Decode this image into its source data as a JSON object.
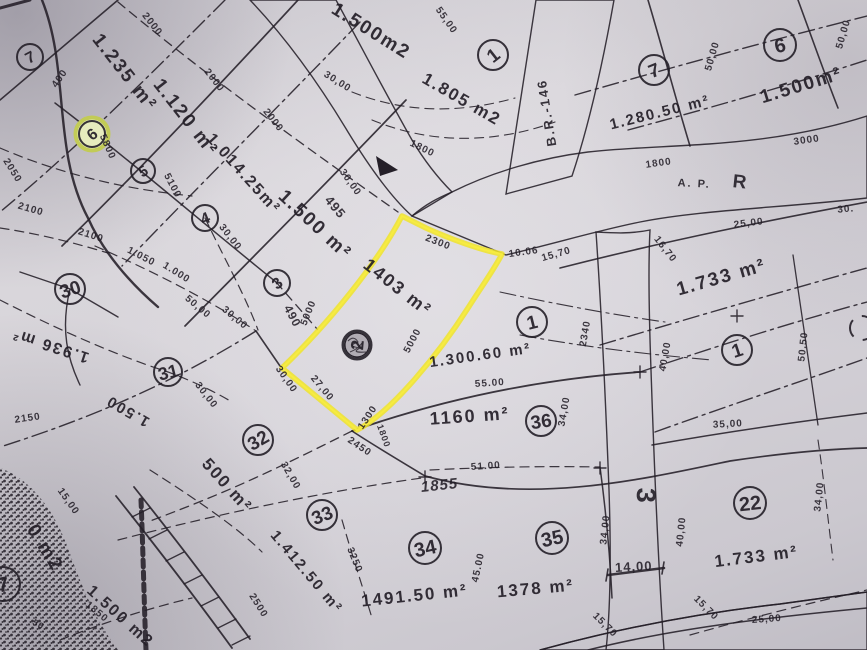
{
  "document": {
    "type_note": "scanned cadastral plat map with one parcel highlighted in yellow marker",
    "highlight_color": "#f0e42a",
    "paper_color": "#d6d3d9",
    "ink_color": "#241f28",
    "highlighted_parcel": {
      "area_label": "1403 m²",
      "lot_number": "2"
    }
  },
  "map": {
    "area_labels": [
      {
        "text": "1.235 m²",
        "x": 120,
        "y": 76,
        "rot": 52,
        "fs": 19
      },
      {
        "text": "1.120 m²",
        "x": 181,
        "y": 121,
        "rot": 52,
        "fs": 19
      },
      {
        "text": "1.014.25m²",
        "x": 240,
        "y": 177,
        "rot": 48,
        "fs": 16
      },
      {
        "text": "1.500 m²",
        "x": 311,
        "y": 229,
        "rot": 43,
        "fs": 19
      },
      {
        "text": "1.500m2",
        "x": 368,
        "y": 36,
        "rot": 32,
        "fs": 19
      },
      {
        "text": "1.805 m2",
        "x": 459,
        "y": 104,
        "rot": 30,
        "fs": 17
      },
      {
        "text": "1.280.50 m²",
        "x": 661,
        "y": 117,
        "rot": -14,
        "fs": 15
      },
      {
        "text": "1.500m²",
        "x": 803,
        "y": 91,
        "rot": -17,
        "fs": 19
      },
      {
        "text": "1.733 m²",
        "x": 723,
        "y": 283,
        "rot": -16,
        "fs": 19
      },
      {
        "text": "1403 m²",
        "x": 394,
        "y": 292,
        "rot": 38,
        "fs": 18
      },
      {
        "text": "1.300.60 m²",
        "x": 481,
        "y": 360,
        "rot": -8,
        "fs": 15
      },
      {
        "text": "1160 m²",
        "x": 470,
        "y": 422,
        "rot": -4,
        "fs": 18
      },
      {
        "text": "1.936 m²",
        "x": 52,
        "y": 341,
        "rot": 198,
        "fs": 16
      },
      {
        "text": "1.500",
        "x": 130,
        "y": 407,
        "rot": 210,
        "fs": 15
      },
      {
        "text": "500 m²",
        "x": 223,
        "y": 489,
        "rot": 48,
        "fs": 17
      },
      {
        "text": "1.412.50 m²",
        "x": 303,
        "y": 575,
        "rot": 50,
        "fs": 15
      },
      {
        "text": "1491.50 m²",
        "x": 415,
        "y": 601,
        "rot": -6,
        "fs": 17
      },
      {
        "text": "1378 m²",
        "x": 536,
        "y": 594,
        "rot": -5,
        "fs": 17
      },
      {
        "text": "1.733 m²",
        "x": 757,
        "y": 562,
        "rot": -7,
        "fs": 17
      },
      {
        "text": "1.500 m2",
        "x": 117,
        "y": 620,
        "rot": 42,
        "fs": 16
      },
      {
        "text": "0 m2",
        "x": 40,
        "y": 551,
        "rot": 58,
        "fs": 19
      }
    ],
    "dimension_labels": [
      {
        "text": "2000",
        "x": 150,
        "y": 26,
        "rot": 52
      },
      {
        "text": "2000",
        "x": 212,
        "y": 82,
        "rot": 52
      },
      {
        "text": "2000",
        "x": 271,
        "y": 122,
        "rot": 52
      },
      {
        "text": "55,00",
        "x": 444,
        "y": 22,
        "rot": 55
      },
      {
        "text": "30,00",
        "x": 336,
        "y": 84,
        "rot": 32
      },
      {
        "text": "30,00",
        "x": 348,
        "y": 184,
        "rot": 55
      },
      {
        "text": "495",
        "x": 332,
        "y": 210,
        "rot": 50,
        "fs": 13
      },
      {
        "text": "1800",
        "x": 421,
        "y": 151,
        "rot": 26
      },
      {
        "text": "2300",
        "x": 437,
        "y": 245,
        "rot": 21
      },
      {
        "text": "10.06",
        "x": 524,
        "y": 255,
        "rot": -8
      },
      {
        "text": "15,70",
        "x": 557,
        "y": 257,
        "rot": -16
      },
      {
        "text": "490",
        "x": 289,
        "y": 318,
        "rot": 62,
        "fs": 12
      },
      {
        "text": "5000",
        "x": 311,
        "y": 314,
        "rot": -68
      },
      {
        "text": "5800",
        "x": 105,
        "y": 148,
        "rot": 66
      },
      {
        "text": "400",
        "x": 62,
        "y": 80,
        "rot": -55
      },
      {
        "text": "2050",
        "x": 10,
        "y": 172,
        "rot": 58
      },
      {
        "text": "5100",
        "x": 170,
        "y": 187,
        "rot": 62
      },
      {
        "text": "2100",
        "x": 30,
        "y": 212,
        "rot": 16
      },
      {
        "text": "2100",
        "x": 90,
        "y": 238,
        "rot": 18
      },
      {
        "text": "1.050",
        "x": 140,
        "y": 259,
        "rot": 27
      },
      {
        "text": "1.000",
        "x": 175,
        "y": 275,
        "rot": 32
      },
      {
        "text": "50,00",
        "x": 196,
        "y": 309,
        "rot": 40
      },
      {
        "text": "30,00",
        "x": 228,
        "y": 239,
        "rot": 52
      },
      {
        "text": "30,00",
        "x": 233,
        "y": 320,
        "rot": 40
      },
      {
        "text": "30,00",
        "x": 204,
        "y": 397,
        "rot": 52
      },
      {
        "text": "2150",
        "x": 28,
        "y": 421,
        "rot": -8
      },
      {
        "text": "30,00",
        "x": 284,
        "y": 381,
        "rot": 55
      },
      {
        "text": "27,00",
        "x": 320,
        "y": 390,
        "rot": 50
      },
      {
        "text": "5000",
        "x": 415,
        "y": 342,
        "rot": -62
      },
      {
        "text": "1300",
        "x": 370,
        "y": 419,
        "rot": -56
      },
      {
        "text": "2450",
        "x": 358,
        "y": 449,
        "rot": 34
      },
      {
        "text": "1800",
        "x": 381,
        "y": 437,
        "rot": 70,
        "fs": 9
      },
      {
        "text": "55.00",
        "x": 490,
        "y": 386,
        "rot": -4
      },
      {
        "text": "51.00",
        "x": 486,
        "y": 469,
        "rot": -4
      },
      {
        "text": "1855",
        "x": 440,
        "y": 490,
        "rot": -6,
        "fs": 15,
        "italic": true
      },
      {
        "text": "32,00",
        "x": 288,
        "y": 477,
        "rot": 60
      },
      {
        "text": "3250",
        "x": 352,
        "y": 561,
        "rot": 68
      },
      {
        "text": "45.00",
        "x": 481,
        "y": 568,
        "rot": -78
      },
      {
        "text": "15,00",
        "x": 66,
        "y": 503,
        "rot": 55
      },
      {
        "text": "2500",
        "x": 256,
        "y": 607,
        "rot": 58
      },
      {
        "text": "1850",
        "x": 95,
        "y": 614,
        "rot": 40
      },
      {
        "text": "50",
        "x": 37,
        "y": 627,
        "rot": 30,
        "fs": 9
      },
      {
        "text": "25,00",
        "x": 749,
        "y": 226,
        "rot": -7
      },
      {
        "text": "30.",
        "x": 846,
        "y": 212,
        "rot": -5
      },
      {
        "text": "16,70",
        "x": 663,
        "y": 251,
        "rot": 52
      },
      {
        "text": "2340",
        "x": 588,
        "y": 334,
        "rot": -80
      },
      {
        "text": "40,00",
        "x": 668,
        "y": 357,
        "rot": -80
      },
      {
        "text": "34,00",
        "x": 567,
        "y": 412,
        "rot": -80
      },
      {
        "text": "50.50",
        "x": 806,
        "y": 347,
        "rot": -84
      },
      {
        "text": "50,00",
        "x": 715,
        "y": 57,
        "rot": -74
      },
      {
        "text": "50,00",
        "x": 846,
        "y": 35,
        "rot": -74
      },
      {
        "text": "3000",
        "x": 807,
        "y": 143,
        "rot": -8
      },
      {
        "text": "1800",
        "x": 659,
        "y": 166,
        "rot": -8
      },
      {
        "text": "35,00",
        "x": 728,
        "y": 427,
        "rot": -3
      },
      {
        "text": "34,00",
        "x": 608,
        "y": 530,
        "rot": -84
      },
      {
        "text": "40,00",
        "x": 684,
        "y": 532,
        "rot": -84
      },
      {
        "text": "14,00",
        "x": 634,
        "y": 571,
        "rot": -3,
        "fs": 13,
        "bold": true
      },
      {
        "text": "15,70",
        "x": 603,
        "y": 627,
        "rot": 45
      },
      {
        "text": "15,70",
        "x": 704,
        "y": 610,
        "rot": 45
      },
      {
        "text": "25,00",
        "x": 767,
        "y": 622,
        "rot": -4
      },
      {
        "text": "34,00",
        "x": 822,
        "y": 497,
        "rot": -84
      }
    ],
    "road_labels": [
      {
        "text": "B.R.-146",
        "x": 551,
        "y": 112,
        "rot": -99,
        "fs": 13
      },
      {
        "text": "A. P.",
        "x": 694,
        "y": 187,
        "rot": 3,
        "fs": 11
      },
      {
        "text": "R",
        "x": 740,
        "y": 188,
        "rot": 6,
        "fs": 19
      },
      {
        "text": "3",
        "x": 637,
        "y": 496,
        "rot": 92,
        "fs": 27
      }
    ],
    "lot_circles": [
      {
        "n": "7",
        "x": 30,
        "y": 57,
        "r": 13,
        "rot": -28
      },
      {
        "n": "6",
        "x": 92,
        "y": 134,
        "r": 13,
        "rot": -38,
        "variant": "highlight"
      },
      {
        "n": "5",
        "x": 143,
        "y": 171,
        "r": 12,
        "rot": -30
      },
      {
        "n": "4",
        "x": 205,
        "y": 218,
        "r": 13,
        "rot": -22
      },
      {
        "n": "3",
        "x": 277,
        "y": 283,
        "r": 13,
        "rot": -38
      },
      {
        "n": "30",
        "x": 70,
        "y": 289,
        "r": 15,
        "rot": -18
      },
      {
        "n": "31",
        "x": 168,
        "y": 372,
        "r": 14,
        "rot": -14
      },
      {
        "n": "2",
        "x": 357,
        "y": 345,
        "r": 14,
        "rot": -85,
        "variant": "scribble"
      },
      {
        "n": "1",
        "x": 493,
        "y": 55,
        "r": 15,
        "rot": -38
      },
      {
        "n": "7",
        "x": 654,
        "y": 70,
        "r": 15,
        "rot": -22
      },
      {
        "n": "6",
        "x": 780,
        "y": 45,
        "r": 16,
        "rot": -12
      },
      {
        "n": "1",
        "x": 532,
        "y": 322,
        "r": 15,
        "rot": -14
      },
      {
        "n": "1",
        "x": 737,
        "y": 350,
        "r": 15,
        "rot": -18
      },
      {
        "n": "36",
        "x": 541,
        "y": 421,
        "r": 15,
        "rot": -8
      },
      {
        "n": "32",
        "x": 258,
        "y": 440,
        "r": 15,
        "rot": -30
      },
      {
        "n": "33",
        "x": 322,
        "y": 515,
        "r": 15,
        "rot": -22
      },
      {
        "n": "34",
        "x": 425,
        "y": 548,
        "r": 16,
        "rot": -12
      },
      {
        "n": "35",
        "x": 552,
        "y": 538,
        "r": 16,
        "rot": -12
      },
      {
        "n": "22",
        "x": 750,
        "y": 503,
        "r": 16,
        "rot": -6
      },
      {
        "n": "7",
        "x": 3,
        "y": 584,
        "r": 17,
        "rot": -12,
        "variant": "partial"
      },
      {
        "n": "",
        "x": 862,
        "y": 328,
        "r": 12,
        "rot": 0,
        "variant": "arc"
      }
    ]
  }
}
